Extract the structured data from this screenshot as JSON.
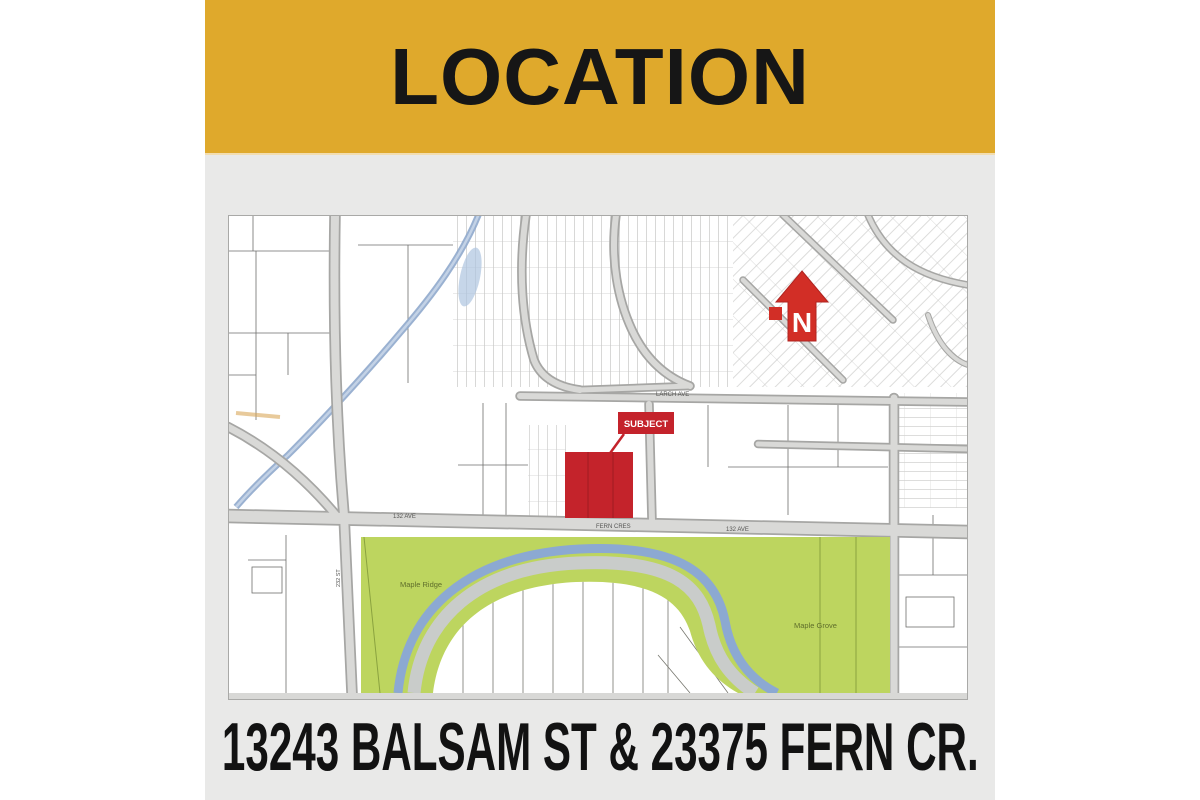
{
  "header": {
    "title": "LOCATION"
  },
  "footer": {
    "address": "13243 BALSAM ST & 23375 FERN CR."
  },
  "map": {
    "subject_marker": {
      "label": "SUBJECT"
    },
    "north_arrow": {
      "label": "N"
    },
    "road_labels": {
      "ave132_left": "132 AVE",
      "fern_cres": "FERN CRES",
      "ave132_right": "132 AVE",
      "larch_ave": "LARCH AVE",
      "st232": "232 ST"
    },
    "area_labels": {
      "left_park": "Maple Ridge",
      "right_park": "Maple Grove"
    },
    "colors": {
      "banner_gold": "#DFA92C",
      "panel_gray": "#E9E9E8",
      "park_green": "#BDD55F",
      "river_blue": "#8CA9D2",
      "road_gray": "#D9D9D7",
      "subject_red": "#C4232B"
    }
  }
}
